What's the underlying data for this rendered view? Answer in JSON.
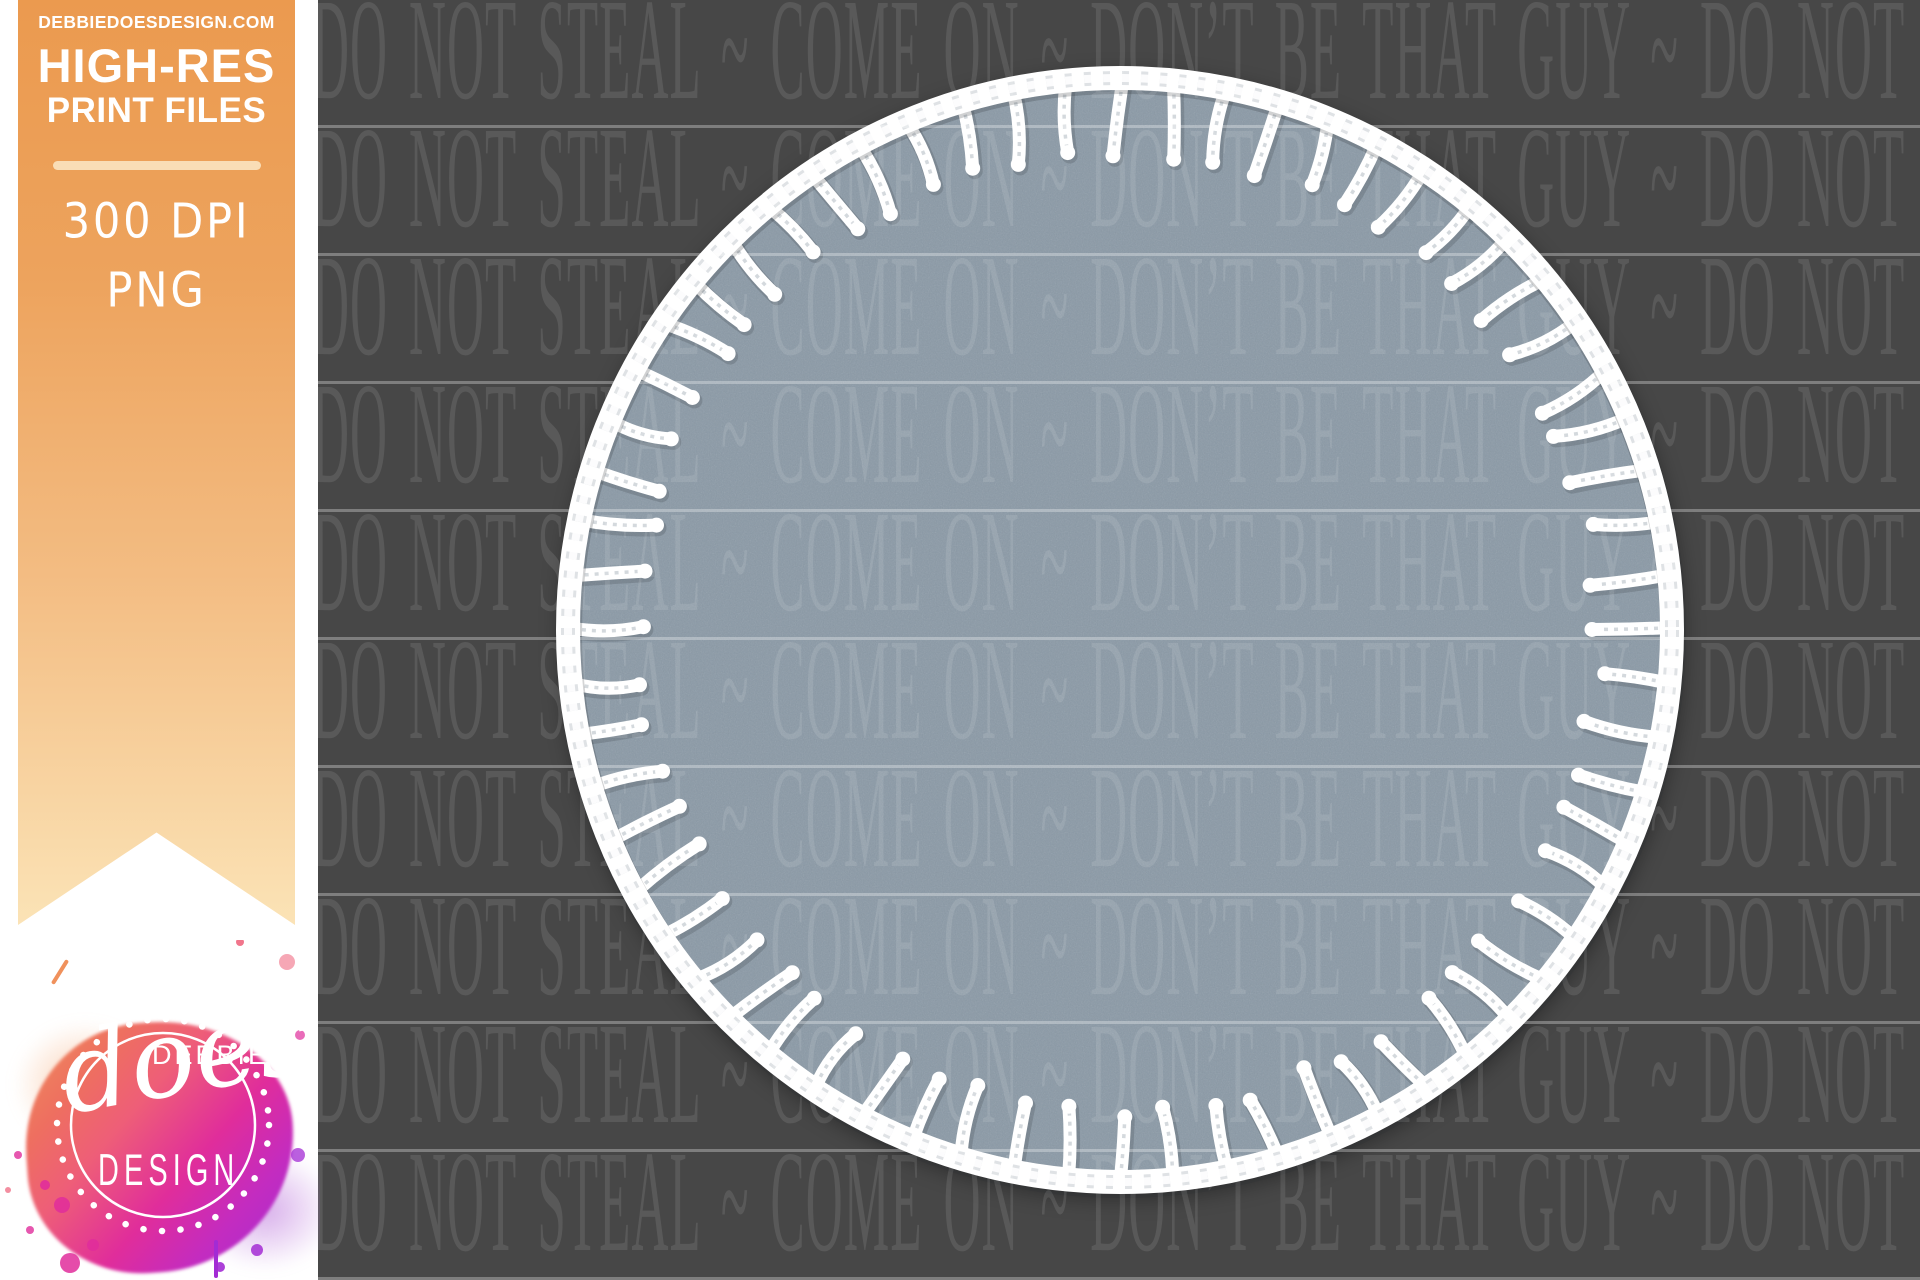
{
  "banner": {
    "website": "DEBBIEDOESDESIGN.COM",
    "headline": "HIGH-RES",
    "subheadline": "PRINT FILES",
    "spec_dpi": "300 DPI",
    "spec_format": "PNG",
    "color_top": "#eb9a4f",
    "color_bottom": "#fbe3b6",
    "text_color": "#ffffff"
  },
  "watermark": {
    "line_text": "DO NOT STEAL ~ COME ON ~ DON’T BE THAT GUY ~ DO NOT STEAL",
    "row_count": 10,
    "background_color": "#474747",
    "text_opacity": 0.1,
    "divider_opacity": 0.3
  },
  "patch": {
    "felt_color": "#8a99a6",
    "stitch_color": "#ffffff",
    "stitch_count": 64
  },
  "logo": {
    "line1": "DEBBIE",
    "line2": "does",
    "line3": "DESIGN",
    "colors": {
      "orange": "#f0915c",
      "pink": "#ee5e78",
      "magenta": "#e02d9b",
      "purple": "#a32bd4"
    }
  }
}
